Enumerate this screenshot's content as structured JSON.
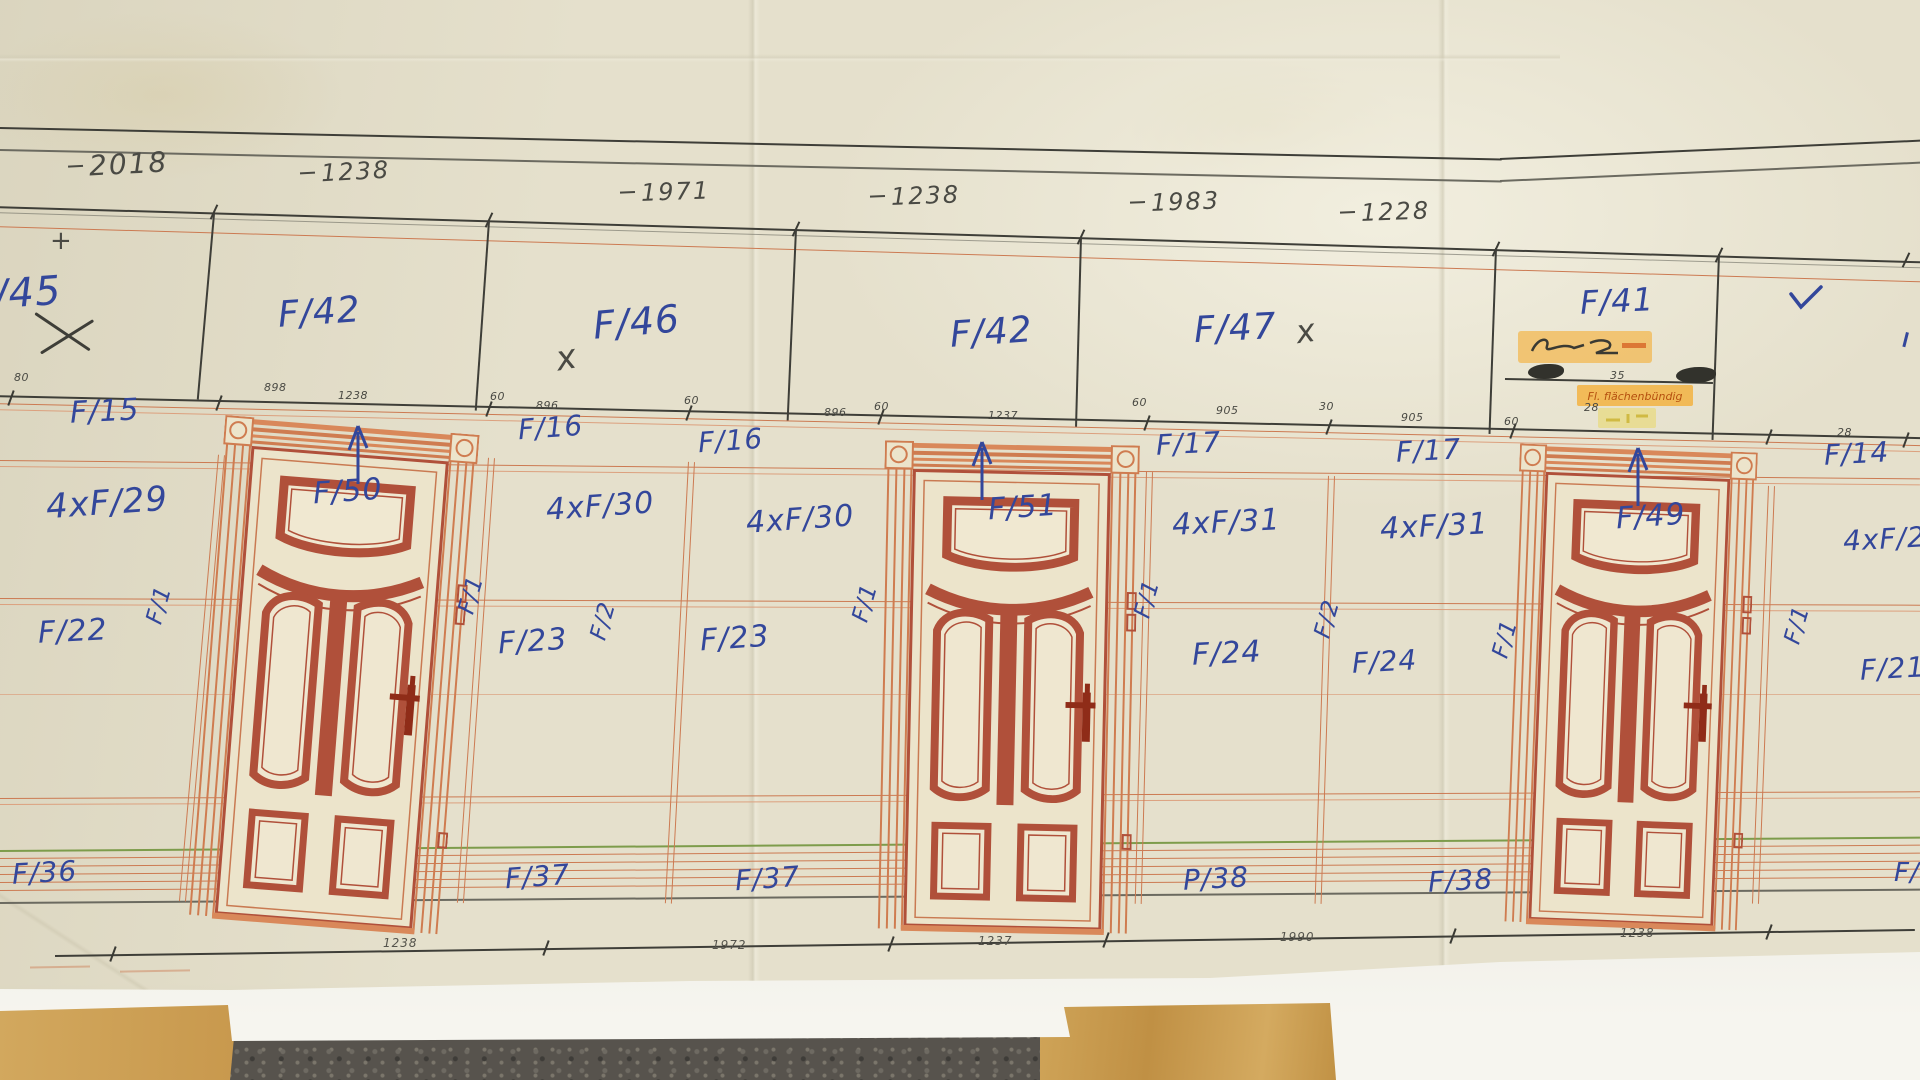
{
  "sheet": {
    "top_dims": [
      "2018",
      "1238",
      "1971",
      "1238",
      "1983",
      "1228"
    ],
    "transom_labels": [
      "/45",
      "F/42",
      "F/46",
      "F/42",
      "F/47",
      "F/41"
    ],
    "pencil_marks": [
      "+",
      "x",
      "x"
    ],
    "rail_labels": [
      "F/15",
      "F/16",
      "F/16",
      "F/17",
      "F/17",
      "F/14"
    ],
    "rail_dims": [
      "80",
      "898",
      "1238",
      "60",
      "896",
      "60",
      "896",
      "60",
      "1237",
      "60",
      "905",
      "30",
      "905",
      "60",
      "35",
      "28",
      "28"
    ],
    "upper_panel_labels": [
      "4xF/29",
      "4xF/30",
      "4xF/30",
      "4xF/31",
      "4xF/31",
      "4xF/22"
    ],
    "mid_panel_labels": [
      "F/22",
      "F/23",
      "F/23",
      "F/24",
      "F/24",
      "F/21"
    ],
    "bottom_panel_labels": [
      "F/36",
      "F/37",
      "F/37",
      "P/38",
      "F/38",
      "F/"
    ],
    "door_labels": [
      "F/50",
      "F/51",
      "F/49"
    ],
    "jamb_labels": [
      "F/1",
      "F/1",
      "F/2",
      "F/1",
      "F/1",
      "F/2",
      "F/1",
      "F/1"
    ],
    "bottom_dims": [
      "1238",
      "1972",
      "1237",
      "1990",
      "1238"
    ],
    "highlight_note": "Fl. flächenbündig",
    "colors": {
      "ink_blue": "#33479b",
      "pencil": "#4a4a44",
      "door_red": "#b0503a",
      "line_salmon": "#cc7a52",
      "highlight_orange": "#f5a823",
      "baseboard_green": "#7d9c4b"
    }
  }
}
